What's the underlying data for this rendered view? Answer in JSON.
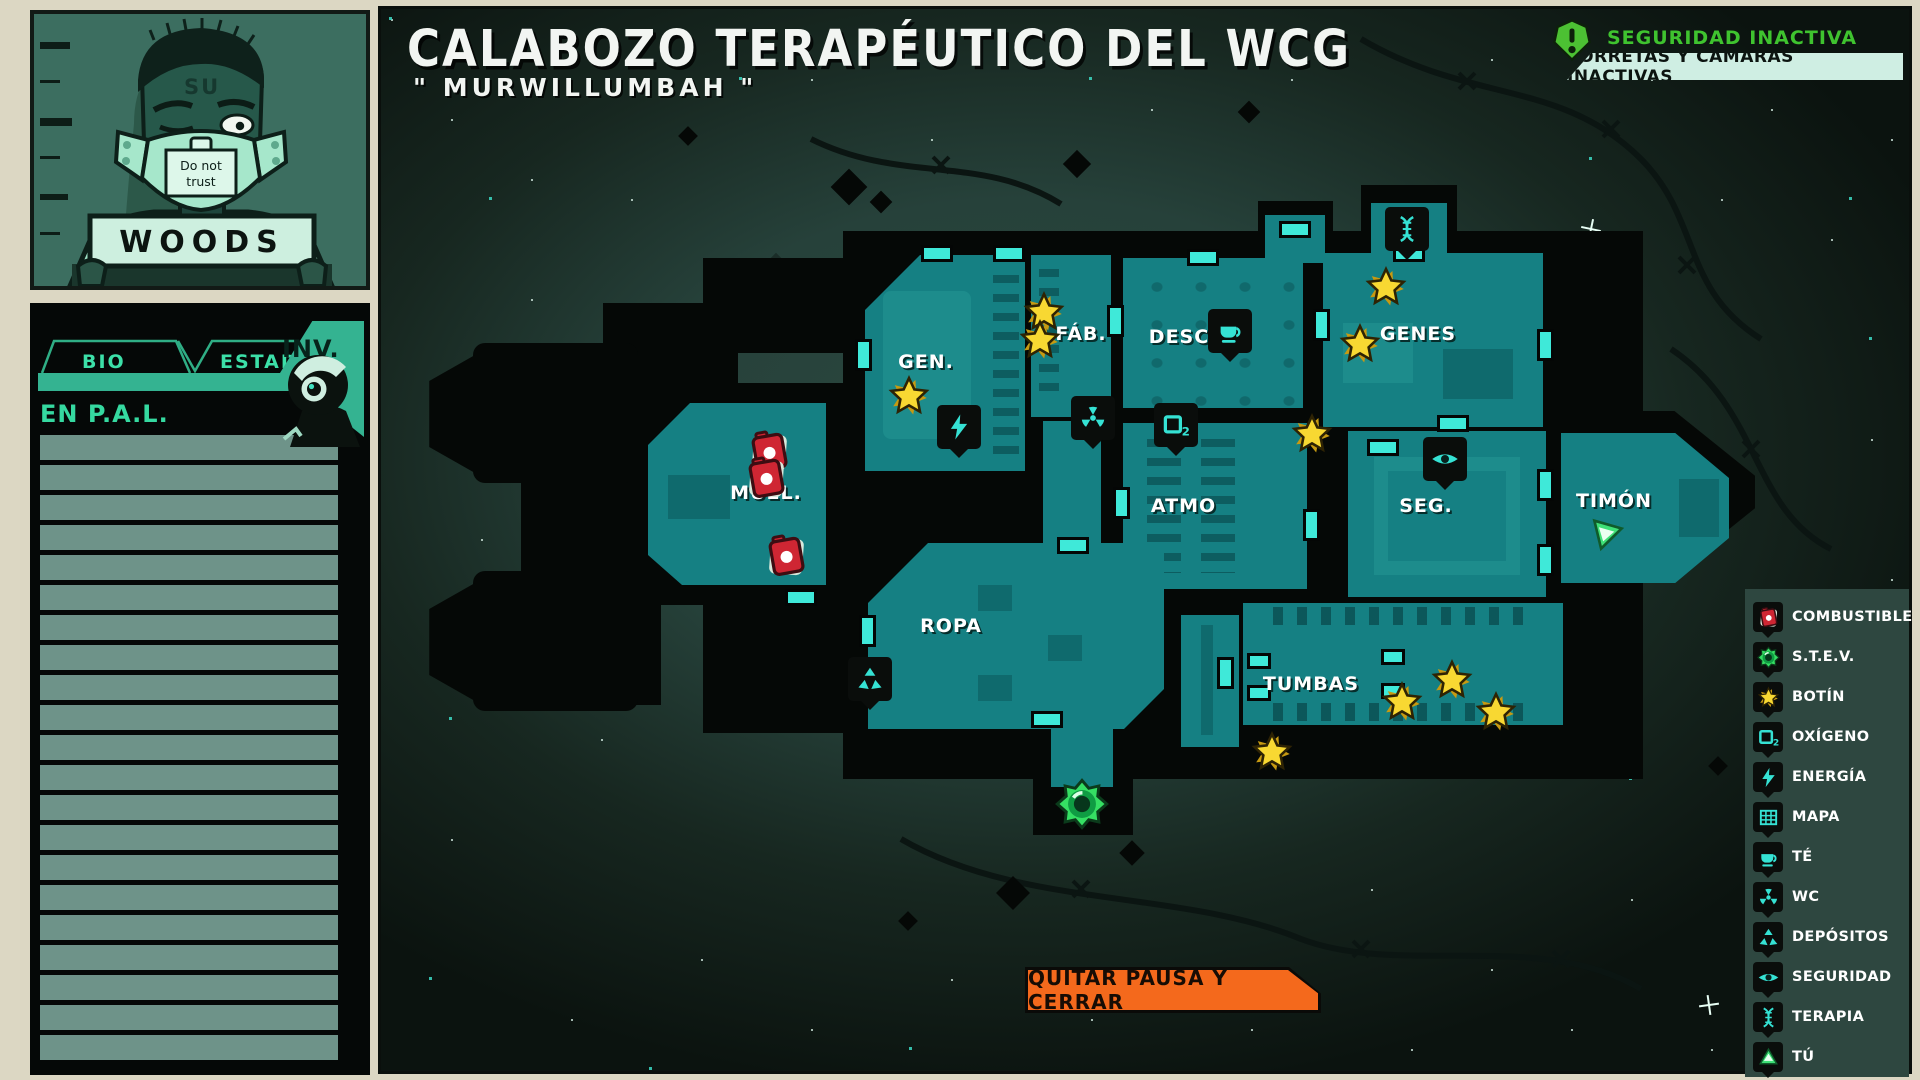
{
  "sidebar": {
    "mugshot": {
      "name": "WOODS",
      "tattoo": "SU",
      "mask_sign_line1": "Do not",
      "mask_sign_line2": "trust"
    },
    "panel": {
      "tabs": [
        {
          "label": "BIO"
        },
        {
          "label": "ESTADO"
        },
        {
          "label": "INV."
        }
      ],
      "active_tab": "INV.",
      "list_heading": "EN P.A.L.",
      "list_rows_visible": 21
    }
  },
  "map": {
    "title": "CALABOZO TERAPÉUTICO DEL WCG",
    "subtitle": "\" MURWILLUMBAH \"",
    "security": {
      "status": "SEGURIDAD INACTIVA",
      "detail": "TORRETAS Y CÁMARAS INACTIVAS"
    },
    "rooms": [
      {
        "label": "GEN."
      },
      {
        "label": "FÁB."
      },
      {
        "label": "DESC"
      },
      {
        "label": "GENES"
      },
      {
        "label": "ATMO"
      },
      {
        "label": "SEG."
      },
      {
        "label": "TIMÓN"
      },
      {
        "label": "MUEL."
      },
      {
        "label": "ROPA"
      },
      {
        "label": "TUMBAS"
      }
    ],
    "pause_button": "QUITAR PAUSA Y CERRAR"
  },
  "legend": {
    "items": [
      {
        "icon": "fuel-icon",
        "label": "COMBUSTIBLE"
      },
      {
        "icon": "stev-icon",
        "label": "S.T.E.V."
      },
      {
        "icon": "star-icon",
        "label": "BOTÍN"
      },
      {
        "icon": "o2-icon",
        "label": "OXÍGENO"
      },
      {
        "icon": "bolt-icon",
        "label": "ENERGÍA"
      },
      {
        "icon": "grid-icon",
        "label": "MAPA"
      },
      {
        "icon": "tea-icon",
        "label": "TÉ"
      },
      {
        "icon": "radiation-icon",
        "label": "WC"
      },
      {
        "icon": "recycle-icon",
        "label": "DEPÓSITOS"
      },
      {
        "icon": "eye-icon",
        "label": "SEGURIDAD"
      },
      {
        "icon": "dna-icon",
        "label": "TERAPIA"
      },
      {
        "icon": "player-icon",
        "label": "TÚ"
      }
    ]
  },
  "colors": {
    "room_teal": "#158083",
    "door_cyan": "#3fe9d9",
    "loot_yellow": "#f8d832",
    "fuel_red": "#cf2633",
    "stev_green": "#35df63",
    "security_green": "#3fc32f",
    "button_orange": "#f4691c",
    "panel_accent": "#34b391",
    "page_cream": "#dcd7c3"
  }
}
